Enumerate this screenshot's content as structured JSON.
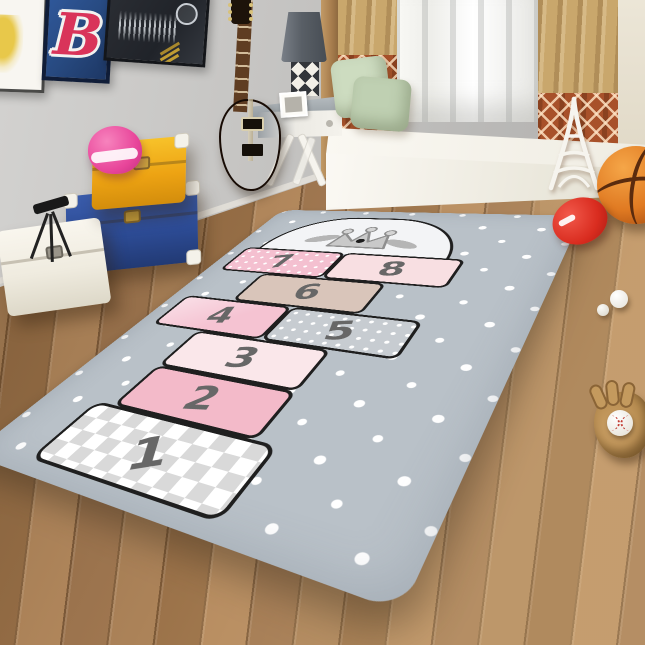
{
  "scene": {
    "type": "product-photo",
    "room": "kids bedroom with wood floor and gray wall",
    "rug": {
      "product": "hopscotch polka-dot play rug",
      "base_color": "#b9c1c8",
      "dot_color": "#ffffff",
      "outline_color": "#1f1f1f",
      "number_color": "#676767",
      "dome_color": "#f3f4f6",
      "crown_color": "#c9c9c9",
      "crown_dot_color": "#1c1c1c",
      "squares": [
        {
          "number": "1",
          "style": "checkerboard",
          "color": "#ffffff",
          "alt_color": "#d9d9d9"
        },
        {
          "number": "2",
          "style": "solid",
          "color": "#f3bac9"
        },
        {
          "number": "3",
          "style": "solid",
          "color": "#fae7ea"
        },
        {
          "number": "4",
          "style": "solid",
          "color": "#f5c3d2"
        },
        {
          "number": "5",
          "style": "polka-dots",
          "color": "#c7ccd1"
        },
        {
          "number": "6",
          "style": "solid",
          "color": "#d9c5ba"
        },
        {
          "number": "7",
          "style": "polka-dots",
          "color": "#f4c0d0"
        },
        {
          "number": "8",
          "style": "solid",
          "color": "#f8dfe2"
        }
      ]
    },
    "decor": {
      "posters": [
        {
          "name": "abstract yellow art print",
          "bg": "#f8f6f1"
        },
        {
          "name": "letter B team logo poster",
          "letter": "B",
          "bg": "#27497f",
          "letter_color": "#d9345a"
        },
        {
          "name": "soundwave art print",
          "bg": "#23262b"
        }
      ],
      "guitar": {
        "style": "sunburst electric guitar",
        "body_color": "#dd8f28"
      },
      "lamp_shade_color": "#595f66",
      "curtains": {
        "tan": "#c9a76c",
        "rust_pattern": "#a8512a"
      },
      "pillows": {
        "green_back": "#cddcc0",
        "green_front": "#bfd0b2",
        "yellow": "#e2cf6e"
      },
      "trunks": {
        "yellow": "#eda313",
        "blue": "#2d4c96",
        "white": "#efebdf"
      },
      "helmet_color": "#e8459a",
      "toys": {
        "basketball": "#e07a22",
        "red_ball": "#d92c1f",
        "baseball_glove": "#b98e52",
        "baseball": "#f7f5f0"
      }
    }
  }
}
